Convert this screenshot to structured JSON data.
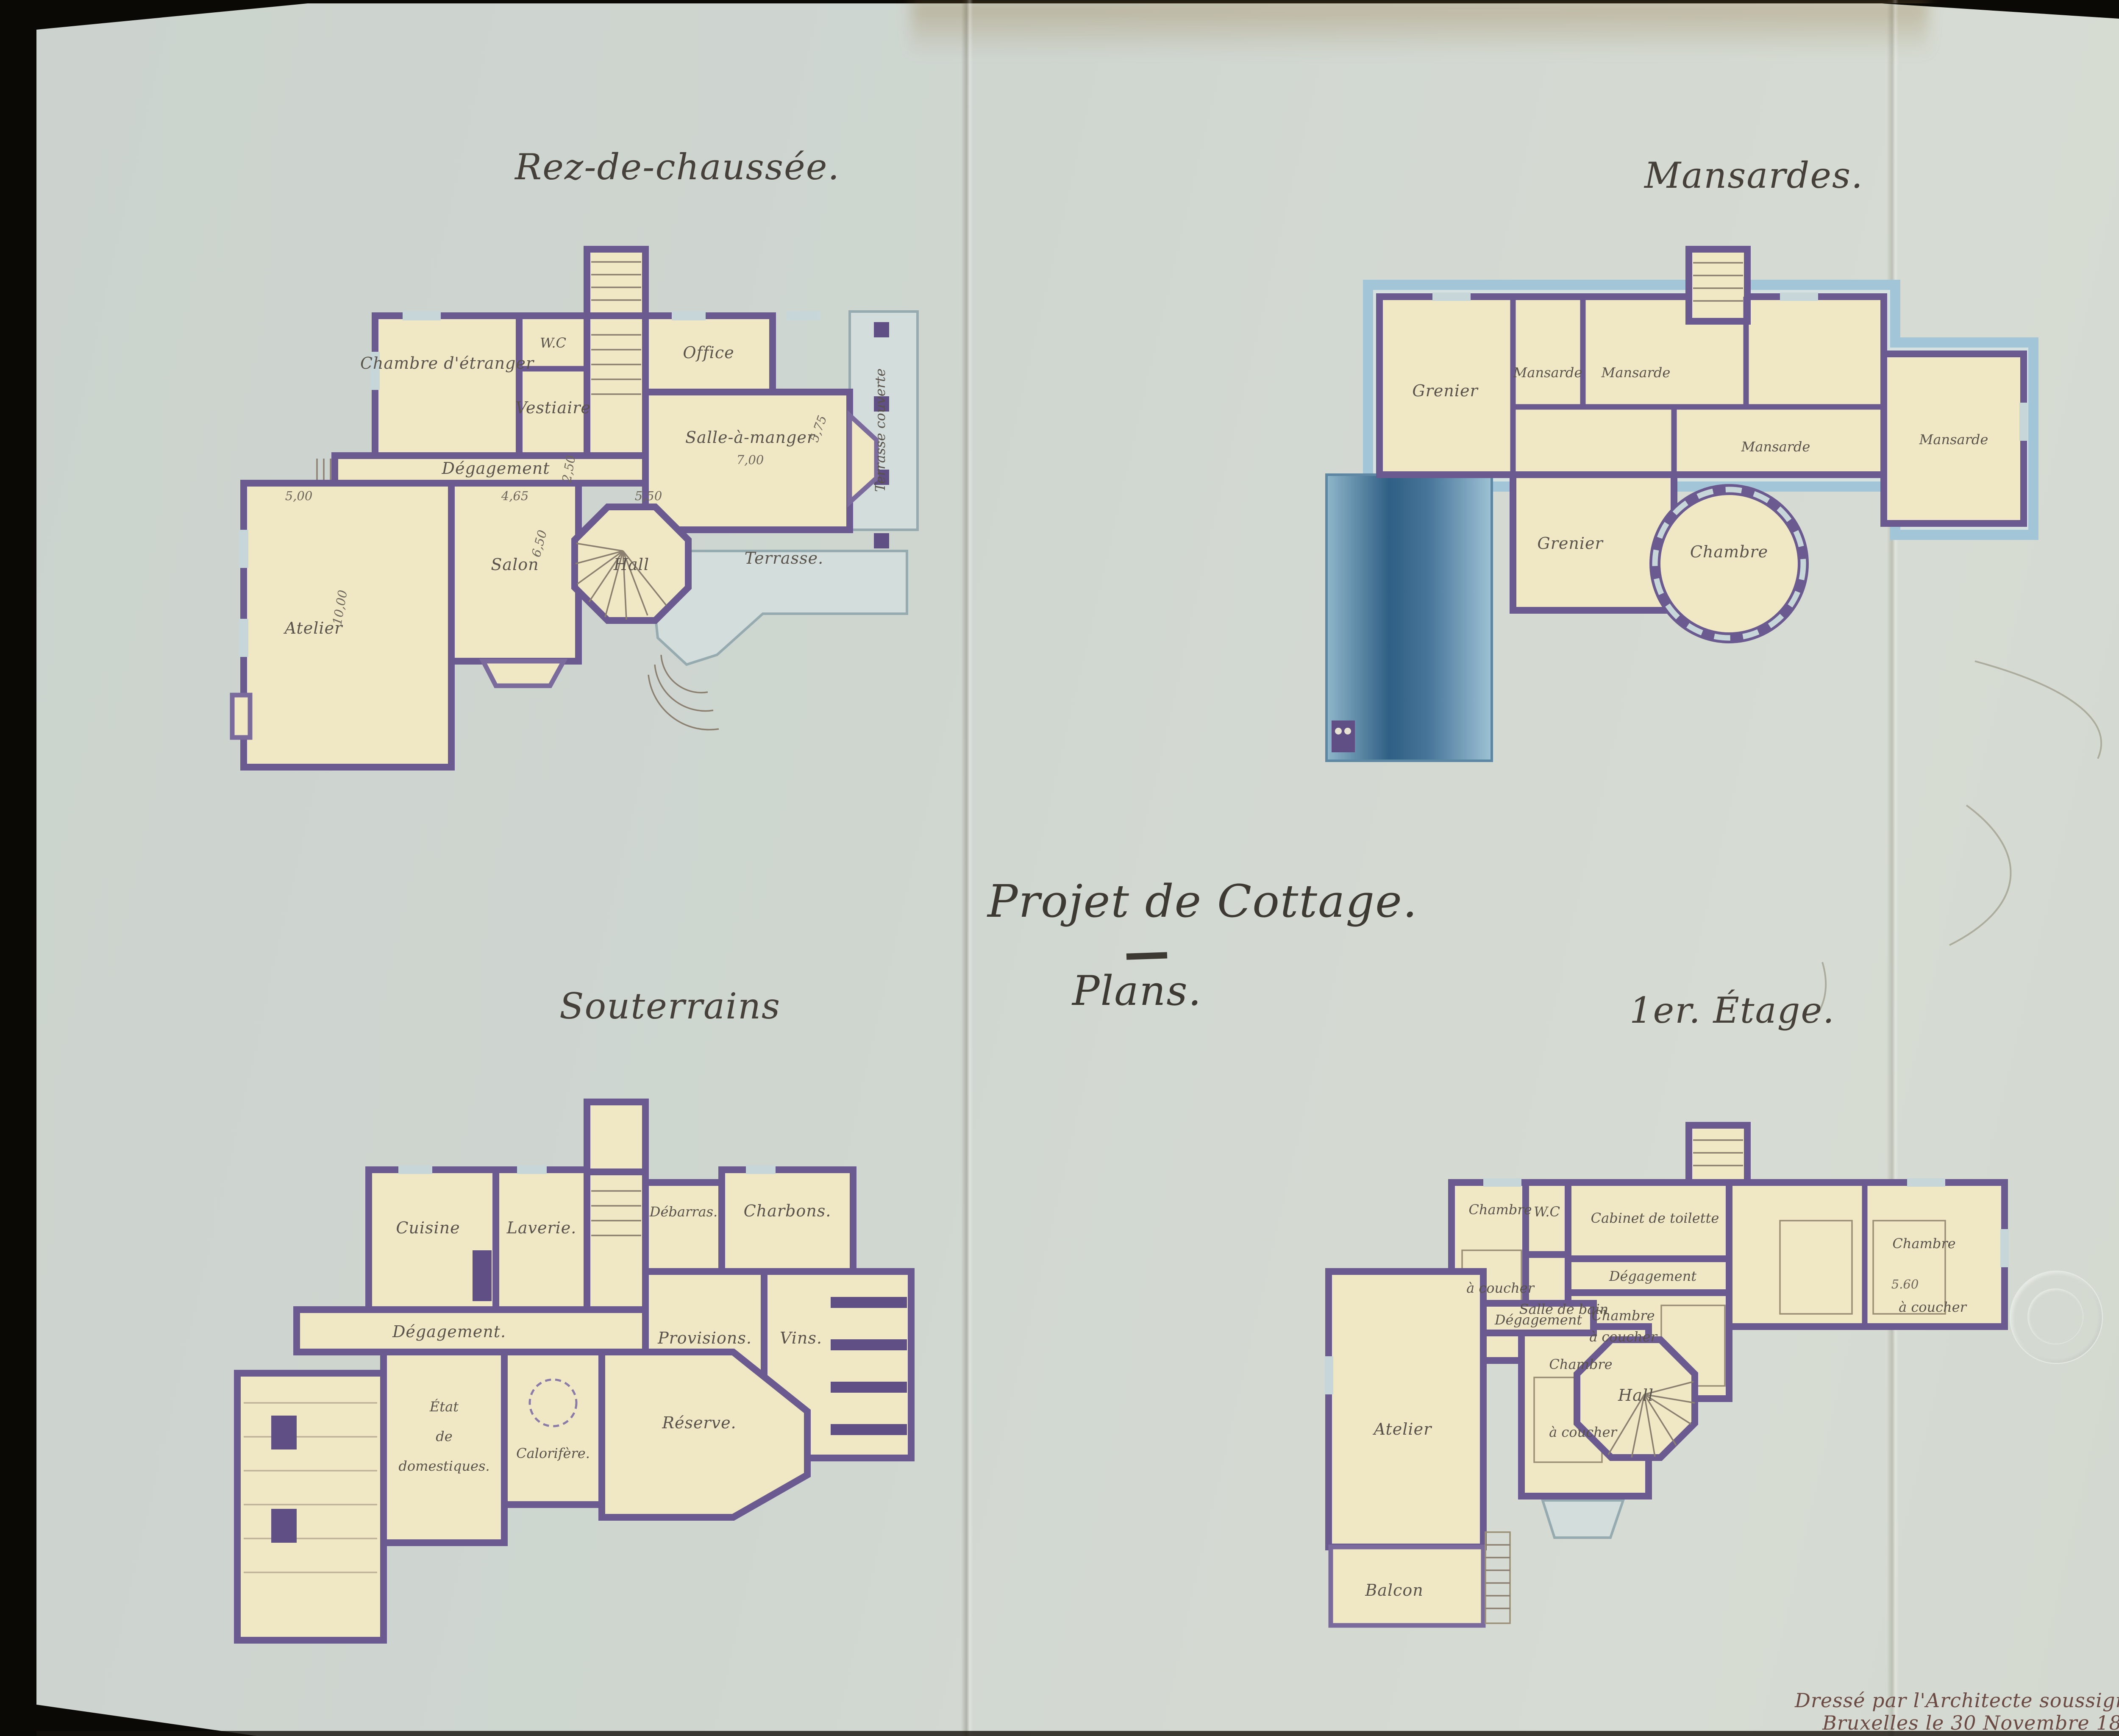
{
  "page": {
    "title": "Projet de Cottage.",
    "subtitle": "Plans.",
    "signature_line1": "Dressé par l'Architecte soussigné",
    "signature_line2": "Bruxelles le 30 Novembre 1896.",
    "paper_color": "#cfd6d0",
    "background_color": "#0b0906"
  },
  "colors": {
    "wall_purple": "#6a5a90",
    "room_cream": "#f0e7c4",
    "terrace_blue": "#d3dedc",
    "roof_band_blue": "#a2c6d7",
    "roof_dark_blue": "#2f5f84",
    "ink": "#59534b",
    "title_ink": "#3d3a33",
    "signature_ink": "#6b4a43"
  },
  "plans": {
    "rez": {
      "title": "Rez-de-chaussée.",
      "rooms": {
        "chambre_etranger": "Chambre d'étranger",
        "wc": "W.C",
        "vestiaire": "Vestiaire",
        "office": "Office",
        "salle_a_manger": "Salle-à-manger",
        "degagement": "Dégagement",
        "salon": "Salon",
        "hall": "Hall",
        "atelier": "Atelier",
        "terrasse_couverte": "Terrasse couverte",
        "terrasse": "Terrasse."
      },
      "dims": {
        "salle": "7,00",
        "salle_bay": "5,75",
        "corridor": "2,50",
        "salon_w": "4,65",
        "salon_h": "6,50",
        "hall_w": "5,50",
        "atelier_w": "5,00",
        "atelier_h": "10,00"
      }
    },
    "mansardes": {
      "title": "Mansardes.",
      "rooms": {
        "mansarde": "Mansarde",
        "grenier": "Grenier",
        "chambre": "Chambre"
      }
    },
    "souterrains": {
      "title": "Souterrains",
      "rooms": {
        "cuisine": "Cuisine",
        "laverie": "Laverie.",
        "debarras": "Débarras.",
        "charbons": "Charbons.",
        "provisions": "Provisions.",
        "vins": "Vins.",
        "degagement": "Dégagement.",
        "etat_line1": "État",
        "etat_line2": "de",
        "etat_line3": "domestiques.",
        "calorifere": "Calorifère.",
        "reserve": "Réserve."
      }
    },
    "etage": {
      "title": "1er. Étage.",
      "rooms": {
        "chambre": "Chambre",
        "a_coucher": "à coucher",
        "wc": "W.C",
        "salle_bain": "Salle de bain",
        "cabinet_toilette": "Cabinet de toilette",
        "degagement": "Dégagement",
        "hall": "Hall",
        "atelier": "Atelier",
        "balcon": "Balcon"
      },
      "dims": {
        "chambre_droite": "5.60"
      }
    }
  }
}
